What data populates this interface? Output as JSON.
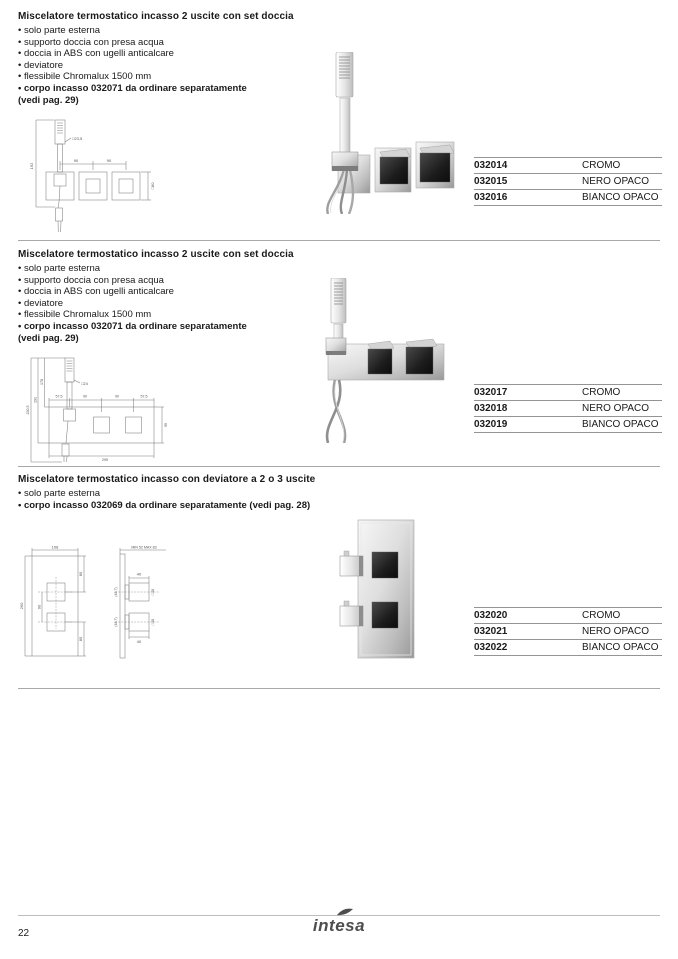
{
  "page": {
    "number": "22",
    "brand_logo": "intesa"
  },
  "colors": {
    "text": "#1a1a1a",
    "rule_gray": "#949494",
    "divider_gray": "#a8a8a8",
    "logo_gray": "#4d4d4d",
    "chrome_dark": "#1c1c1c"
  },
  "sections": [
    {
      "title": "Miscelatore termostatico incasso 2 uscite con set doccia",
      "bullets": [
        "solo parte esterna",
        "supporto doccia con presa acqua",
        "doccia in ABS con ugelli anticalcare",
        "deviatore",
        "flessibile Chromalux 1500 mm",
        "corpo incasso 032071 da ordinare separatamente"
      ],
      "note": "(vedi pag. 29)",
      "table": [
        {
          "code": "032014",
          "finish": "CROMO"
        },
        {
          "code": "032015",
          "finish": "NERO OPACO"
        },
        {
          "code": "032016",
          "finish": "BIANCO OPACO"
        }
      ],
      "dims": {
        "wand_length": "192",
        "shower_head": "□23,5",
        "spacing_left": "90",
        "spacing_right": "90",
        "plate": "□80"
      }
    },
    {
      "title": "Miscelatore termostatico incasso 2 uscite con set doccia",
      "bullets": [
        "solo parte esterna",
        "supporto doccia con presa acqua",
        "doccia in ABS con ugelli anticalcare",
        "deviatore",
        "flessibile Chromalux 1500 mm",
        "corpo incasso 032071 da ordinare separatamente"
      ],
      "note": "(vedi pag. 29)",
      "table": [
        {
          "code": "032017",
          "finish": "CROMO"
        },
        {
          "code": "032018",
          "finish": "NERO OPACO"
        },
        {
          "code": "032019",
          "finish": "BIANCO OPACO"
        }
      ],
      "dims": {
        "total_height": "230,5",
        "height_to_plate": "191",
        "height_to_top": "178",
        "shower_head": "□24",
        "edge_left": "57,5",
        "spacing_left": "90",
        "spacing_right": "90",
        "edge_right": "57,5",
        "plate_height": "95",
        "plate_width": "295"
      }
    },
    {
      "title": "Miscelatore termostatico incasso con deviatore a 2 o 3 uscite",
      "bullets": [
        "solo parte esterna",
        "corpo incasso 032069 da ordinare separatamente (vedi pag. 28)"
      ],
      "table": [
        {
          "code": "032020",
          "finish": "CROMO"
        },
        {
          "code": "032021",
          "finish": "NERO OPACO"
        },
        {
          "code": "032022",
          "finish": "BIANCO OPACO"
        }
      ],
      "dims": {
        "plate_width": "108",
        "plate_height": "260",
        "edge_top": "80",
        "spacing": "90",
        "edge_bottom": "80",
        "depth_range": "MIN 52 MAX 83",
        "knob_depth_top": "40",
        "knob_size_top": "□48",
        "knob_side_top": "(48,7)",
        "knob_depth_bottom": "40",
        "knob_size_bottom": "□48",
        "knob_side_bottom": "(48,7)"
      }
    }
  ]
}
